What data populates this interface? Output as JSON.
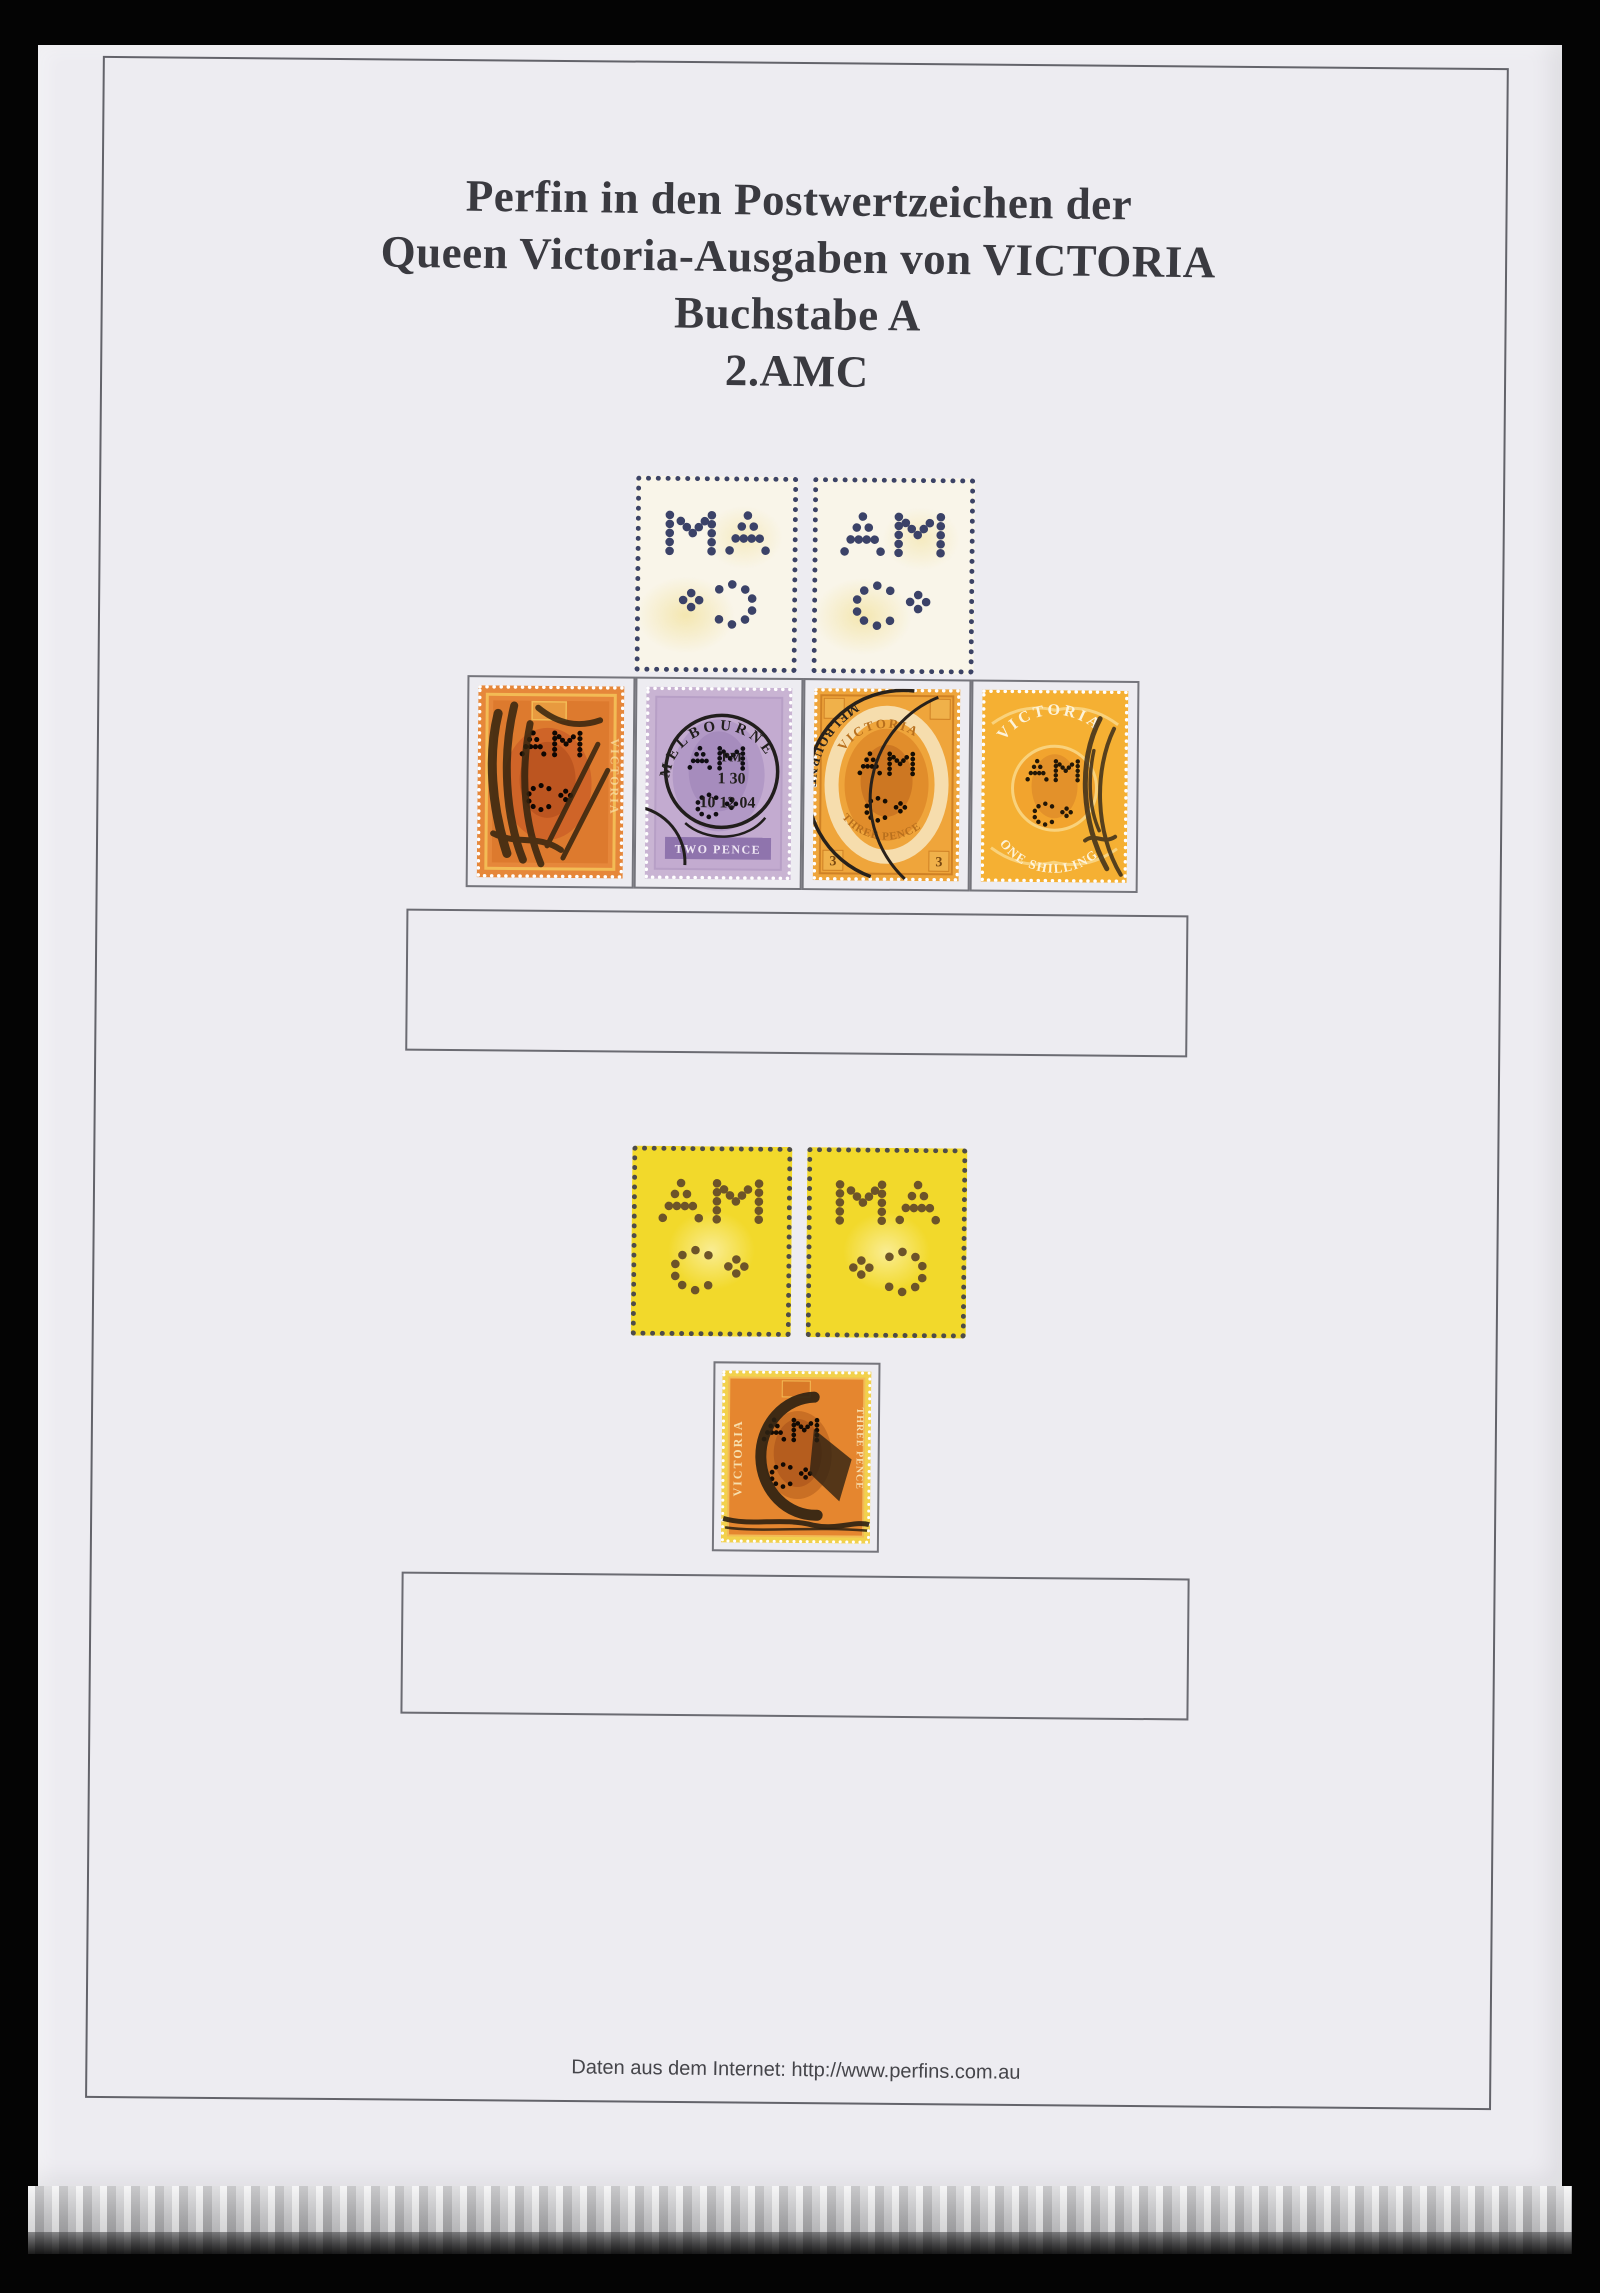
{
  "title": {
    "lines": [
      "Perfin in den Postwertzeichen der",
      "Queen Victoria-Ausgaben von VICTORIA",
      "Buchstabe A",
      "2.AMC"
    ]
  },
  "footer": {
    "text": "Daten aus dem Internet: http://www.perfins.com.au"
  },
  "perfin": {
    "letters": "AMC"
  },
  "colors": {
    "background": "#000000",
    "paper": "#edecf1",
    "frame_line": "#63636a",
    "title_text": "#3a3a40",
    "diagram_fill": "#f9f5e9",
    "diagram_dots": "#3b4268",
    "yellow_stamp": "#f2d92b",
    "yellow_dots": "#6d5429"
  },
  "stamps": {
    "row": [
      {
        "label": "orange Victoria stamp with heavy black postmark",
        "country": "VICTORIA"
      },
      {
        "label": "lilac Two Pence with Melbourne circular datestamp",
        "town": "MELBOURNE",
        "pm": "PM",
        "time": "1 30",
        "date": "10 12 04",
        "value": "TWO PENCE"
      },
      {
        "label": "orange Three Pence with Melbourne arc postmark",
        "country": "VICTORIA",
        "value": "THREE PENCE",
        "numeral": "3",
        "town": "MELBOURNE"
      },
      {
        "label": "orange One Shilling with corner cancel",
        "country": "VICTORIA",
        "value": "ONE SHILLING"
      }
    ],
    "single": {
      "label": "orange Three Pence with heavy C-shaped cancel",
      "country": "VICTORIA",
      "value": "THREE PENCE"
    }
  }
}
